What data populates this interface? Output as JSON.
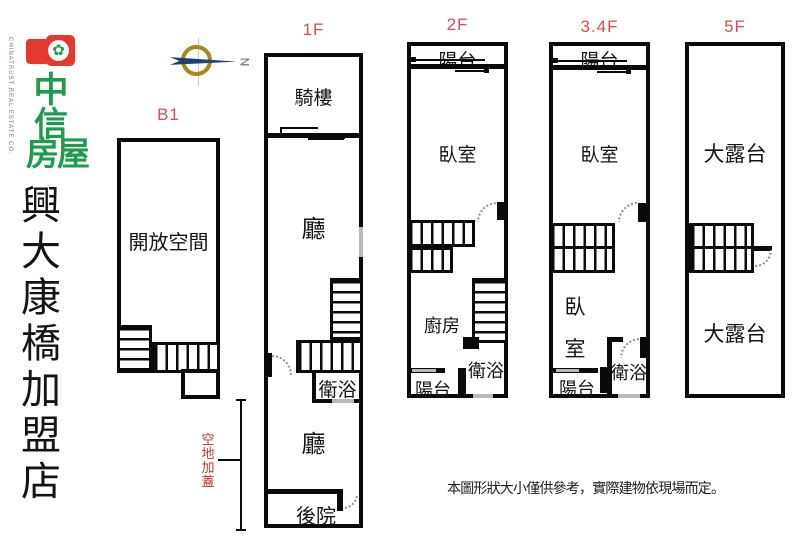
{
  "logo": {
    "emblem_symbol": "✿",
    "company_en": "CHINATRUST REAL ESTATE CO.",
    "company_char1": "中",
    "company_char2": "信",
    "company_char3": "房屋",
    "store_name": "興大康橋加盟店"
  },
  "compass": {
    "north": "N"
  },
  "floors": [
    {
      "id": "b1",
      "label": "B1",
      "rooms": {
        "main": "開放空間"
      }
    },
    {
      "id": "f1",
      "label": "1F",
      "rooms": {
        "arcade": "騎樓",
        "hall_upper": "廳",
        "bath": "衛浴",
        "hall_lower": "廳",
        "backyard": "後院"
      },
      "note": "空地加蓋"
    },
    {
      "id": "f2",
      "label": "2F",
      "rooms": {
        "balcony_top": "陽台",
        "bedroom": "臥室",
        "kitchen": "廚房",
        "bath": "衛浴",
        "balcony_bottom": "陽台"
      }
    },
    {
      "id": "f34",
      "label": "3.4F",
      "rooms": {
        "balcony_top": "陽台",
        "bedroom_top": "臥室",
        "bedroom_mid": "臥室",
        "bath": "衛浴",
        "balcony_bottom": "陽台"
      }
    },
    {
      "id": "f5",
      "label": "5F",
      "rooms": {
        "terrace_top": "大露台",
        "terrace_bottom": "大露台"
      }
    }
  ],
  "disclaimer": "本圖形狀大小僅供參考，實際建物依現場而定。",
  "colors": {
    "floor_label_red": "#e24a50",
    "annotation_red": "#c2382f",
    "wall_black": "#0a0a0a",
    "window_gray": "#b2bcc0",
    "logo_red": "#e6382e",
    "logo_green": "#1e9b4f",
    "compass_gold": "#a8861a",
    "compass_navy": "#1c3f6e"
  }
}
